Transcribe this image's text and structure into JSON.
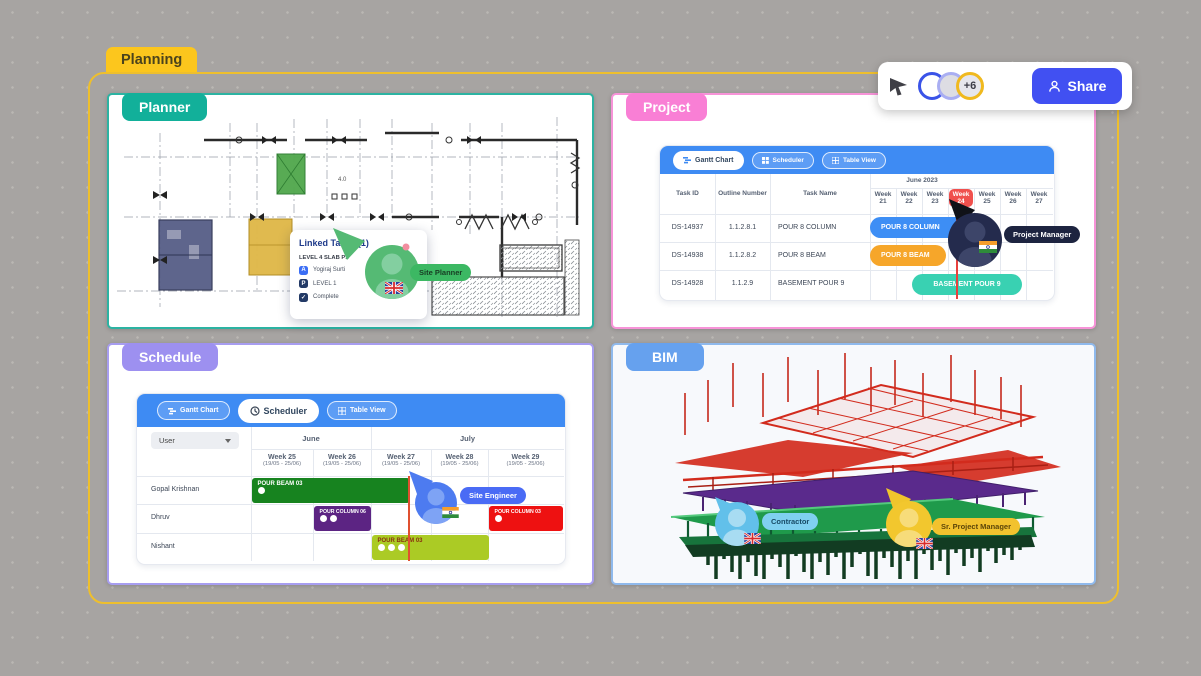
{
  "canvas": {
    "tab_label": "Planning"
  },
  "share_bar": {
    "cursor_icon": "pointer-arrow",
    "avatars_overflow": "+6",
    "share_label": "Share",
    "colors": {
      "avatar_ring_1": "#3a53e8",
      "avatar_ring_2": "#a9aef2",
      "avatar_ring_3": "#f0b91e",
      "share_button": "#4150f2"
    }
  },
  "panels": {
    "planner": {
      "label": "Planner",
      "accent": "#12b09a",
      "popup": {
        "title": "Linked Tasks (1)",
        "task": "LEVEL 4 SLAB P1",
        "rows": [
          {
            "badge": "A",
            "text": "Yogiraj Surti"
          },
          {
            "badge": "P",
            "text": "LEVEL 1"
          },
          {
            "badge": "✓",
            "text": "Complete"
          }
        ]
      },
      "cursor": {
        "label": "Site Planner",
        "color": "#3cb863",
        "flag": "uk"
      }
    },
    "project": {
      "label": "Project",
      "accent": "#f97fd5",
      "tabs": [
        {
          "label": "Gantt Chart",
          "active": true
        },
        {
          "label": "Scheduler",
          "active": false
        },
        {
          "label": "Table View",
          "active": false
        }
      ],
      "columns": [
        "Task ID",
        "Outline Number",
        "Task Name"
      ],
      "month_header": "June 2023",
      "weeks": [
        "Week 21",
        "Week 22",
        "Week 23",
        "Week 24",
        "Week 25",
        "Week 26",
        "Week 27"
      ],
      "highlighted_week": "Week 24",
      "rows": [
        {
          "task_id": "DS-14937",
          "outline_number": "1.1.2.8.1",
          "task_name": "POUR 8 COLUMN",
          "bar_label": "POUR 8 COLUMN",
          "bar_color": "#3d8ef5"
        },
        {
          "task_id": "DS-14938",
          "outline_number": "1.1.2.8.2",
          "task_name": "POUR 8 BEAM",
          "bar_label": "POUR 8 BEAM",
          "bar_color": "#f6a62a"
        },
        {
          "task_id": "DS-14928",
          "outline_number": "1.1.2.9",
          "task_name": "BASEMENT POUR 9",
          "bar_label": "BASEMENT POUR 9",
          "bar_color": "#39d1b2"
        }
      ],
      "cursor": {
        "label": "Project Manager",
        "color": "#242b4d",
        "flag": "india"
      }
    },
    "schedule": {
      "label": "Schedule",
      "accent": "#9d90f0",
      "tabs": [
        {
          "label": "Gantt Chart",
          "active": false
        },
        {
          "label": "Scheduler",
          "active": true
        },
        {
          "label": "Table View",
          "active": false
        }
      ],
      "filter_label": "User",
      "months": [
        {
          "label": "June"
        },
        {
          "label": "July"
        }
      ],
      "weeks": [
        {
          "name": "Week 25",
          "range": "(19/05 - 25/06)"
        },
        {
          "name": "Week 26",
          "range": "(19/05 - 25/06)"
        },
        {
          "name": "Week 27",
          "range": "(19/05 - 25/06)"
        },
        {
          "name": "Week 28",
          "range": "(19/05 - 25/06)"
        },
        {
          "name": "Week 29",
          "range": "(19/05 - 25/06)"
        }
      ],
      "rows": [
        {
          "user": "Gopal Krishnan",
          "bars": [
            {
              "label": "POUR BEAM 03",
              "color": "#17831f",
              "dots": 1
            }
          ]
        },
        {
          "user": "Dhruv",
          "bars": [
            {
              "label": "POUR COLUMN 06",
              "color": "#5c2483",
              "dots": 2
            },
            {
              "label": "POUR COLUMN 03",
              "color": "#ee1111",
              "dots": 1
            }
          ]
        },
        {
          "user": "Nishant",
          "bars": [
            {
              "label": "POUR BEAM 03",
              "color": "#abcb25",
              "dots": 3
            }
          ]
        }
      ],
      "cursor": {
        "label": "Site Engineer",
        "color": "#4a6bf5",
        "flag": "india"
      }
    },
    "bim": {
      "label": "BIM",
      "accent": "#66a1ee",
      "cursors": [
        {
          "label": "Contractor",
          "color": "#62c0ea",
          "flag": "uk"
        },
        {
          "label": "Sr. Project Manager",
          "color": "#f2c72e",
          "flag": "uk"
        }
      ]
    }
  }
}
